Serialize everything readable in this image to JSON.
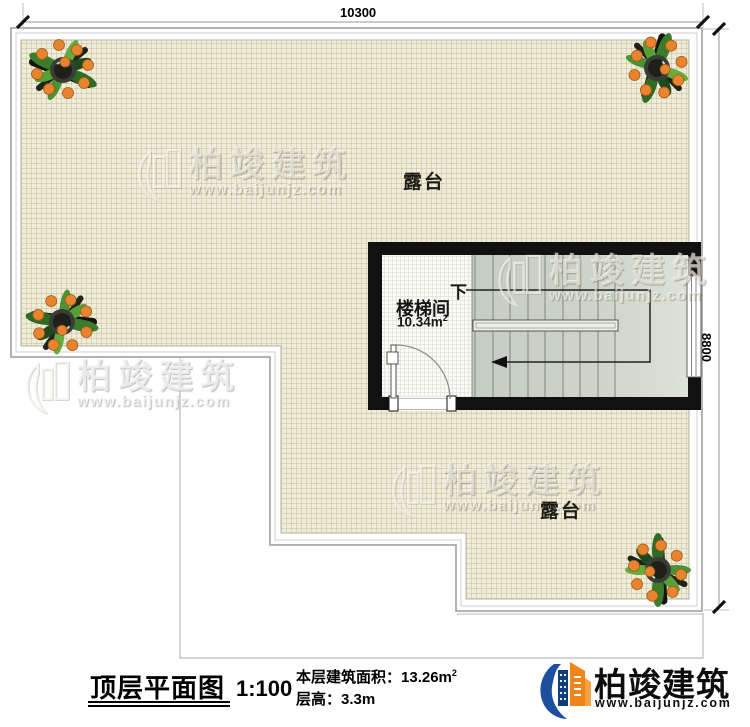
{
  "dimensions": {
    "top": "10300",
    "right": "8800"
  },
  "plan": {
    "terrace_upper": "露台",
    "terrace_lower": "露台",
    "stair_room": "楼梯间",
    "stair_area_value": "10.34m",
    "stair_area_sup": "2",
    "down": "下"
  },
  "watermark": {
    "brand": "柏竣建筑",
    "url": "www.baijunjz.com"
  },
  "title_block": {
    "title": "顶层平面图",
    "scale": "1:100",
    "area_label": "本层建筑面积：",
    "area_value": "13.26m",
    "area_sup": "2",
    "floor_height": "层高：3.3m"
  },
  "brand": {
    "name": "柏竣建筑",
    "url": "www.baijunjz.com"
  },
  "colors": {
    "wall_black": "#111111",
    "terrace_cream": "#efecd9",
    "stair_gray": "#cdd3ca",
    "brand_blue": "#1b4e9b",
    "brand_orange": "#f08519"
  }
}
